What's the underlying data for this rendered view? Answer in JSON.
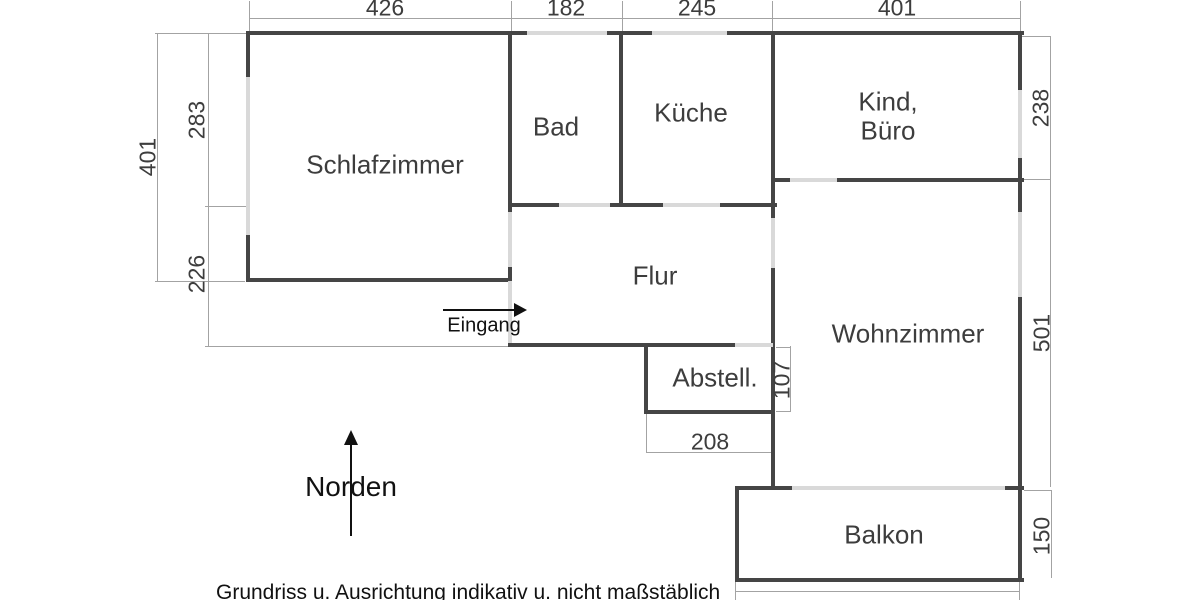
{
  "disclaimer": "Grundriss u. Ausrichtung indikativ u. nicht maßstäblich",
  "compass": {
    "label": "Norden"
  },
  "entrance": {
    "label": "Eingang"
  },
  "rooms": {
    "schlafzimmer": {
      "label": "Schlafzimmer"
    },
    "bad": {
      "label": "Bad"
    },
    "kueche": {
      "label": "Küche"
    },
    "kind_buero": {
      "line1": "Kind,",
      "line2": "Büro"
    },
    "flur": {
      "label": "Flur"
    },
    "wohnzimmer": {
      "label": "Wohnzimmer"
    },
    "abstellraum": {
      "label": "Abstell."
    },
    "balkon": {
      "label": "Balkon"
    }
  },
  "dimensions_cm": {
    "top": {
      "schlafzimmer_width": "426",
      "bad_width": "182",
      "kueche_width": "245",
      "kind_buero_width": "401"
    },
    "left": {
      "upper": "283",
      "total": "401",
      "lower": "226"
    },
    "right": {
      "kind_buero_height": "238",
      "wohnzimmer_height": "501",
      "balkon_height": "150"
    },
    "inner": {
      "abstell_height": "107",
      "abstell_width": "208"
    }
  },
  "colors": {
    "wall": "#454545",
    "opening": "#d9d9d9",
    "dim_line": "#a3a3a3",
    "room_text": "#3d3d3d",
    "annotation_text": "#111111"
  }
}
